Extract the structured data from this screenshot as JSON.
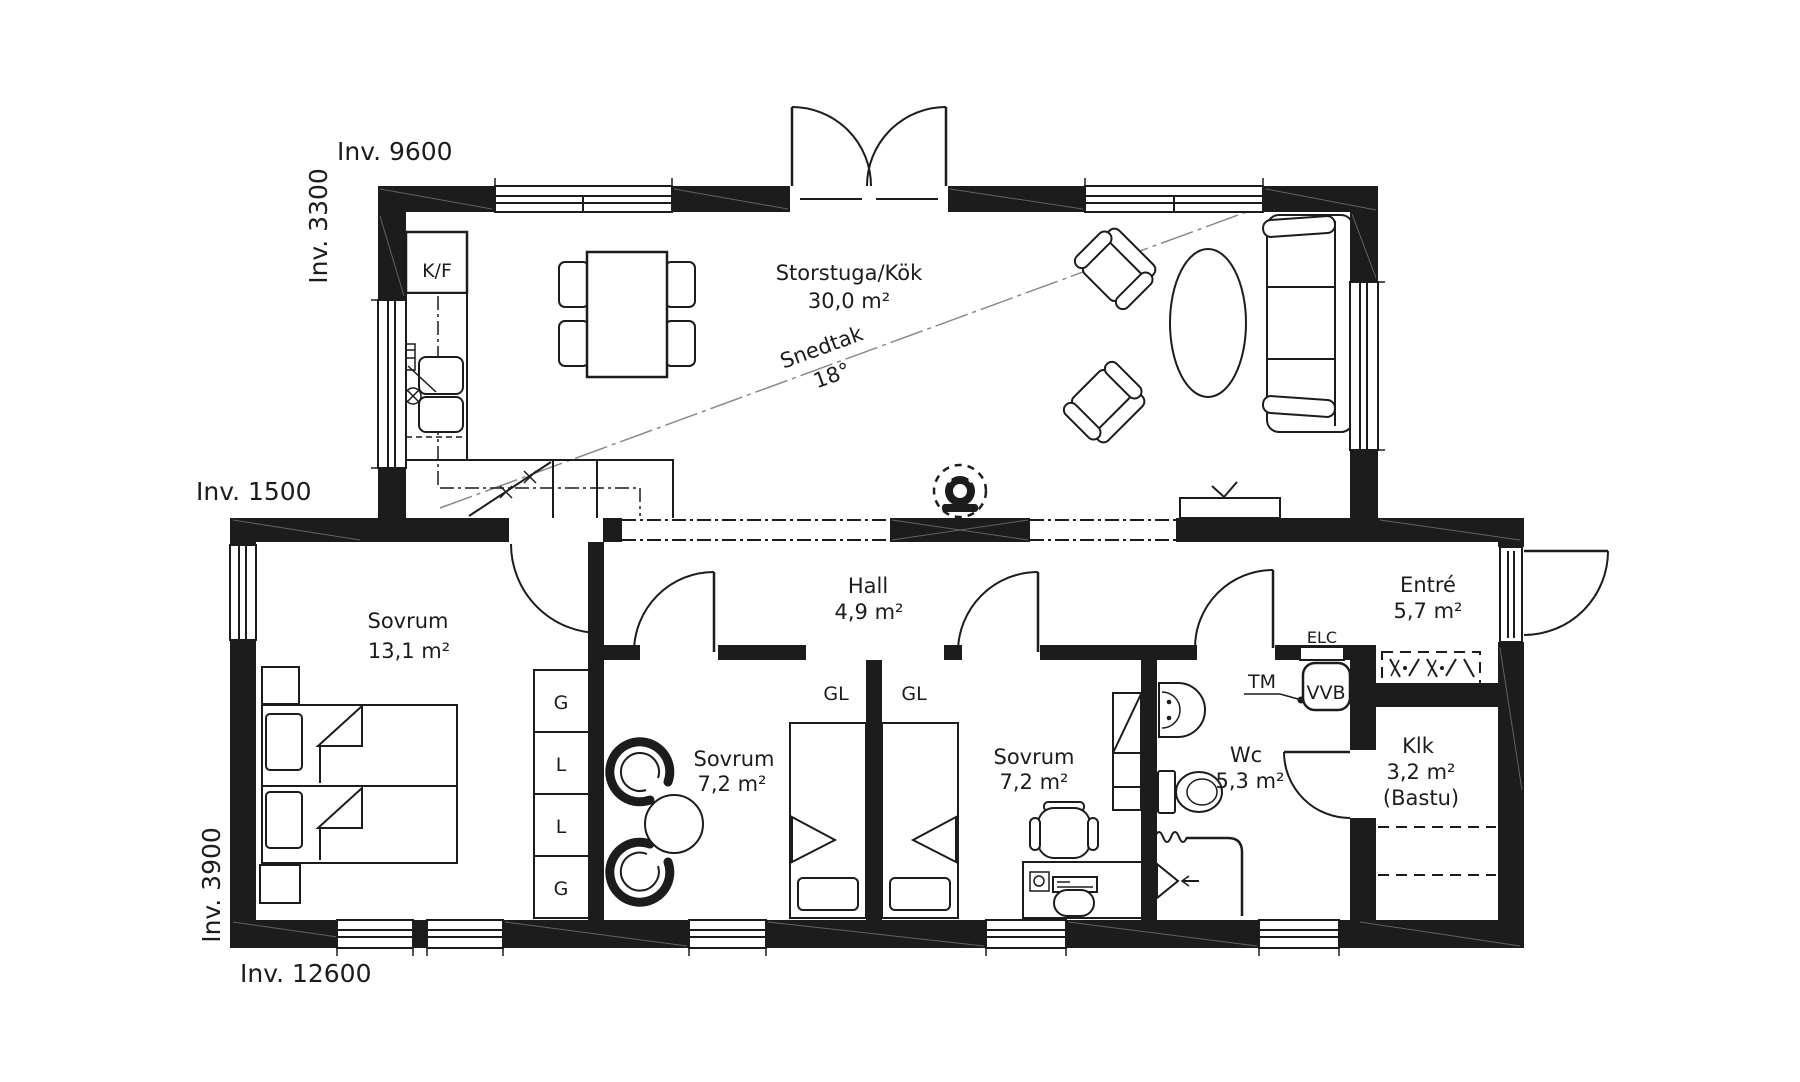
{
  "plan": {
    "bg": "#ffffff",
    "wall_color": "#1c1c1c",
    "dims": {
      "top": "Inv. 9600",
      "left_upper": "Inv. 3300",
      "left_middle": "Inv. 1500",
      "left_lower": "Inv. 3900",
      "bottom": "Inv. 12600"
    },
    "rooms": {
      "storstuga": {
        "name": "Storstuga/Kök",
        "area": "30,0 m²"
      },
      "hall": {
        "name": "Hall",
        "area": "4,9 m²"
      },
      "sovrum_master": {
        "name": "Sovrum",
        "area": "13,1 m²"
      },
      "sovrum_mid": {
        "name": "Sovrum",
        "area": "7,2 m²"
      },
      "sovrum_right": {
        "name": "Sovrum",
        "area": "7,2 m²"
      },
      "wc": {
        "name": "Wc",
        "area": "5,3 m²"
      },
      "entre": {
        "name": "Entré",
        "area": "5,7 m²"
      },
      "klk": {
        "name": "Klk",
        "area": "3,2 m²",
        "note": "(Bastu)"
      }
    },
    "annotations": {
      "snedtak": {
        "label": "Snedtak",
        "value": "18°"
      }
    },
    "fixtures": {
      "fridge_freezer": "K/F",
      "electrical": "ELC",
      "washing_machine": "TM",
      "water_heater": "VVB",
      "closet_left": "GL",
      "closet_right": "GL",
      "wardrobe_cells": [
        "G",
        "L",
        "L",
        "G"
      ]
    }
  }
}
